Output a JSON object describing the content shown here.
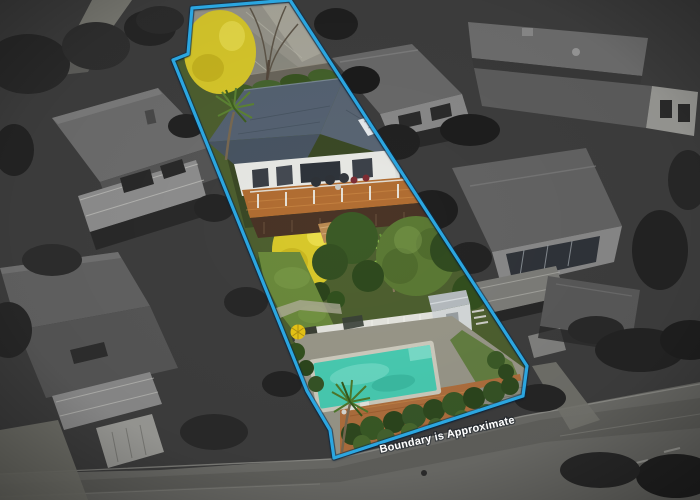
{
  "boundary": {
    "label": "Boundary is Approximate",
    "label_color": "#FFFFFF",
    "line_color": "#2BA6E0",
    "halo_color": "#0B3150"
  },
  "palette": {
    "surroundings_base": "#3E3E3E",
    "pool_water": "#49CDB3",
    "lawn": "#6B8A3C",
    "foliage_yellow": "#D9C92B",
    "roof_slate": "#5A6674",
    "deck_timber": "#B26E33",
    "patio_brick": "#B0703E"
  }
}
